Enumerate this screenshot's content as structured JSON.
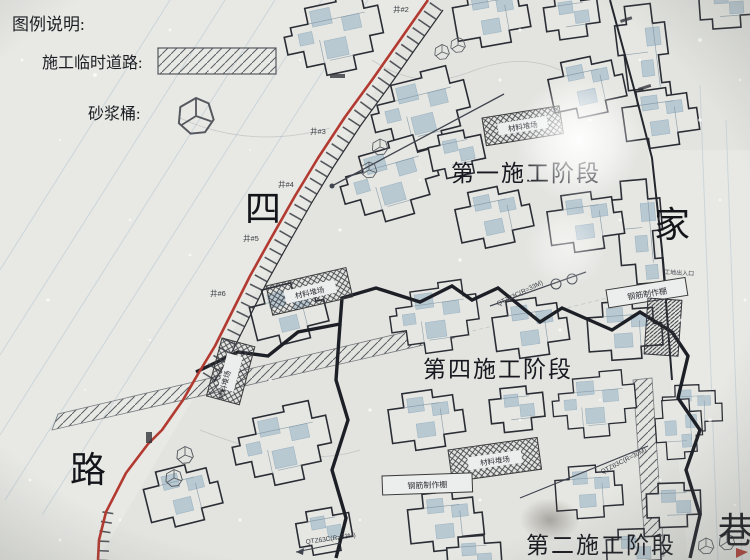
{
  "legend": {
    "title": "图例说明:",
    "temp_road_label": "施工临时道路:",
    "mortar_bucket_label": "砂浆桶:"
  },
  "streets": {
    "west_top": "四",
    "west_bottom": "路",
    "east_top": "家",
    "east_bottom": "巷"
  },
  "phases": {
    "phase_1": "第一施工阶段",
    "phase_4": "第四施工阶段",
    "phase_2": "第二施工阶段"
  },
  "facilities": {
    "material_yard": "材料堆场",
    "rebar_shed": "钢筋制作棚",
    "site_entrance": "工地出入口",
    "crane_r33": "QTZ63C(R=33M)",
    "crane_r30": "QTZ63C(R=30M)"
  },
  "manholes": [
    "井#2",
    "井#3",
    "井#4",
    "井#5",
    "井#6"
  ],
  "colors": {
    "paper": "#e3e4e0",
    "boundary_red": "#b23a31",
    "line_dark": "#24262e",
    "detail_blue": "#8fb0c6"
  }
}
